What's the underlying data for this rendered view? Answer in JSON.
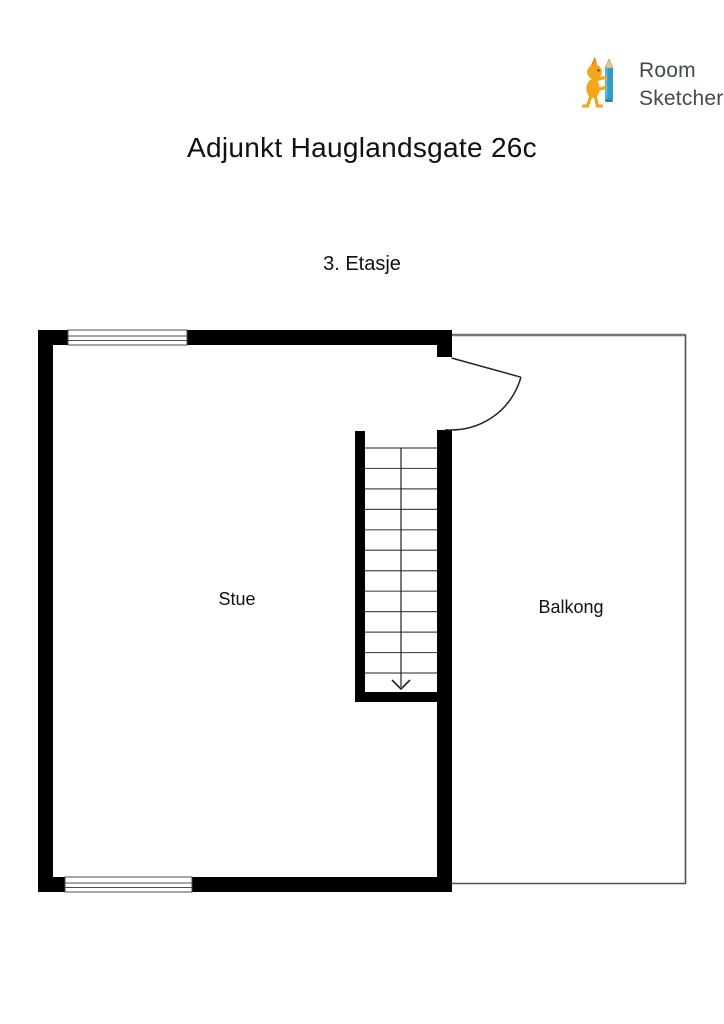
{
  "header": {
    "logo": {
      "line1": "Room",
      "line2": "Sketcher",
      "registered_mark": "®"
    },
    "title": "Adjunkt Hauglandsgate 26c"
  },
  "floor": {
    "label": "3. Etasje"
  },
  "floor_plan": {
    "rooms": [
      {
        "name": "Stue"
      },
      {
        "name": "Balkong"
      }
    ],
    "stairs": {
      "visible_treads": 12,
      "direction": "down"
    },
    "colors": {
      "wall": "#000000",
      "window_line": "#4d4d4d",
      "door_line": "#222222",
      "stair_line": "#4d4d4d",
      "balcony_outline_top": "#757575",
      "balcony_outline_side": "#4f4f4f",
      "logo_text": "#414b47",
      "logo_pencil": "#2b9fc6",
      "logo_character": "#f2a71b"
    }
  }
}
